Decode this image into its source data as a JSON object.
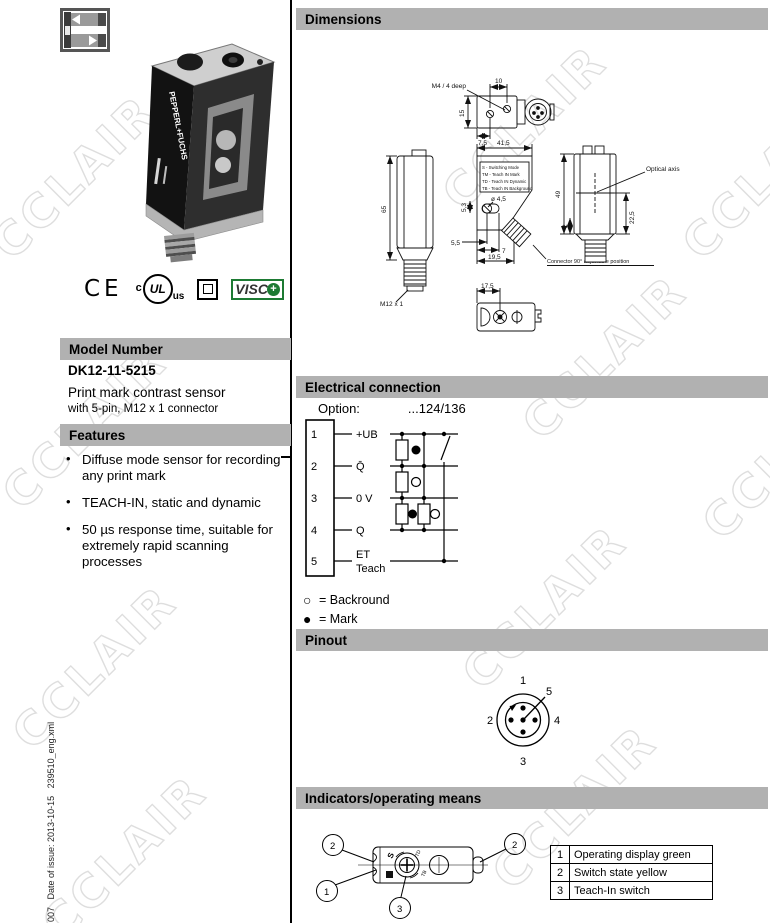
{
  "page": {
    "watermark": "CCLAIR",
    "side_note": "007   Date of issue: 2013-10-15   239510_eng.xml"
  },
  "product": {
    "brand": "PEPPERL+FUCHS",
    "certifications": {
      "ce": "CE",
      "ul_c": "c",
      "ul": "UL",
      "ul_us": "us",
      "visco": "VISC",
      "visco_plus": "+"
    },
    "model": {
      "header": "Model Number",
      "number": "DK12-11-5215",
      "description": "Print mark contrast sensor",
      "subdescription": "with 5-pin, M12 x 1 connector"
    },
    "features": {
      "header": "Features",
      "items": [
        "Diffuse mode sensor for recording any print mark",
        "TEACH-IN, static and dynamic",
        "50 µs response time, suitable for extremely rapid scanning processes"
      ]
    }
  },
  "dimensions": {
    "title": "Dimensions",
    "labels": {
      "m4": "M4 / 4 deep",
      "d10": "10",
      "d15": "15",
      "d7_5": "7,5",
      "d41_5": "41,5",
      "d65": "65",
      "m12": "M12 x 1",
      "mode_s": "S   - Switching Mode",
      "mode_tm": "TM - Teach IN Mark",
      "mode_td": "TD - Teach IN Dynamic",
      "mode_tb": "TB - Teach IN Background",
      "d5_3": "5,3",
      "dia4_5": "ø 4,5",
      "d5_5": "5,5",
      "d7": "7",
      "d19_5": "19,5",
      "d49": "49",
      "d2": "2",
      "d22_5": "22,5",
      "optical_axis": "Optical axis",
      "connector_note": "Connector 90° adjustable position",
      "d17_5": "17,5"
    }
  },
  "electrical": {
    "title": "Electrical connection",
    "option_label": "Option:",
    "option_value": "...124/136",
    "pins": [
      {
        "num": "1",
        "label": "+UB"
      },
      {
        "num": "2",
        "label": "Q̄"
      },
      {
        "num": "3",
        "label": "0 V"
      },
      {
        "num": "4",
        "label": "Q"
      },
      {
        "num": "5",
        "label": "ET",
        "label2": "Teach"
      }
    ],
    "legend": [
      {
        "symbol": "○",
        "text": "= Backround"
      },
      {
        "symbol": "●",
        "text": "= Mark"
      }
    ]
  },
  "pinout": {
    "title": "Pinout",
    "pins": {
      "p1": "1",
      "p2": "2",
      "p3": "3",
      "p4": "4",
      "p5": "5"
    }
  },
  "indicators": {
    "title": "Indicators/operating means",
    "callouts": {
      "c1": "1",
      "c2": "2",
      "c3": "3"
    },
    "table": [
      {
        "num": "1",
        "text": "Operating display green"
      },
      {
        "num": "2",
        "text": "Switch state yellow"
      },
      {
        "num": "3",
        "text": "Teach-In switch"
      }
    ]
  }
}
